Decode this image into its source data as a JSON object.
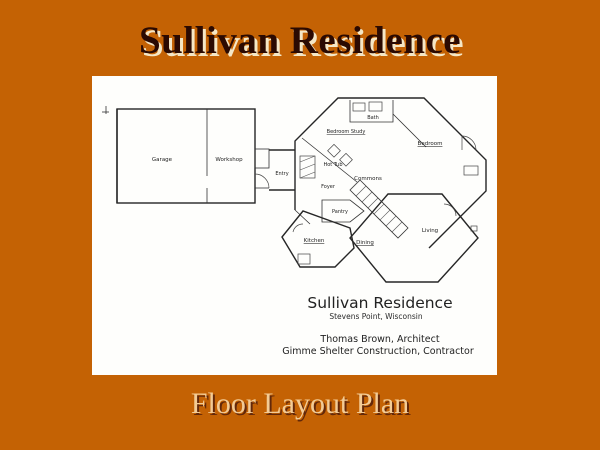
{
  "slide": {
    "title": "Sullivan Residence",
    "caption": "Floor Layout Plan",
    "colors": {
      "background": "#C46204",
      "title_text": "#2B0A02",
      "title_shadow": "#F5E7C6",
      "caption_text": "#F3CB95",
      "caption_shadow": "#63280A",
      "plan_background": "#FEFEFC",
      "plan_ink": "#262626"
    }
  },
  "floorplan": {
    "heading": "Sullivan Residence",
    "location": "Stevens Point, Wisconsin",
    "architect": "Thomas Brown, Architect",
    "contractor": "Gimme Shelter Construction, Contractor",
    "rooms": {
      "garage": "Garage",
      "workshop": "Workshop",
      "entry": "Entry",
      "bath": "Bath",
      "bedroom_study": "Bedroom Study",
      "bedroom": "Bedroom",
      "hot_tub": "Hot Tub",
      "foyer": "Foyer",
      "commons": "Commons",
      "pantry": "Pantry",
      "kitchen": "Kitchen",
      "dining": "Dining",
      "living": "Living"
    }
  }
}
